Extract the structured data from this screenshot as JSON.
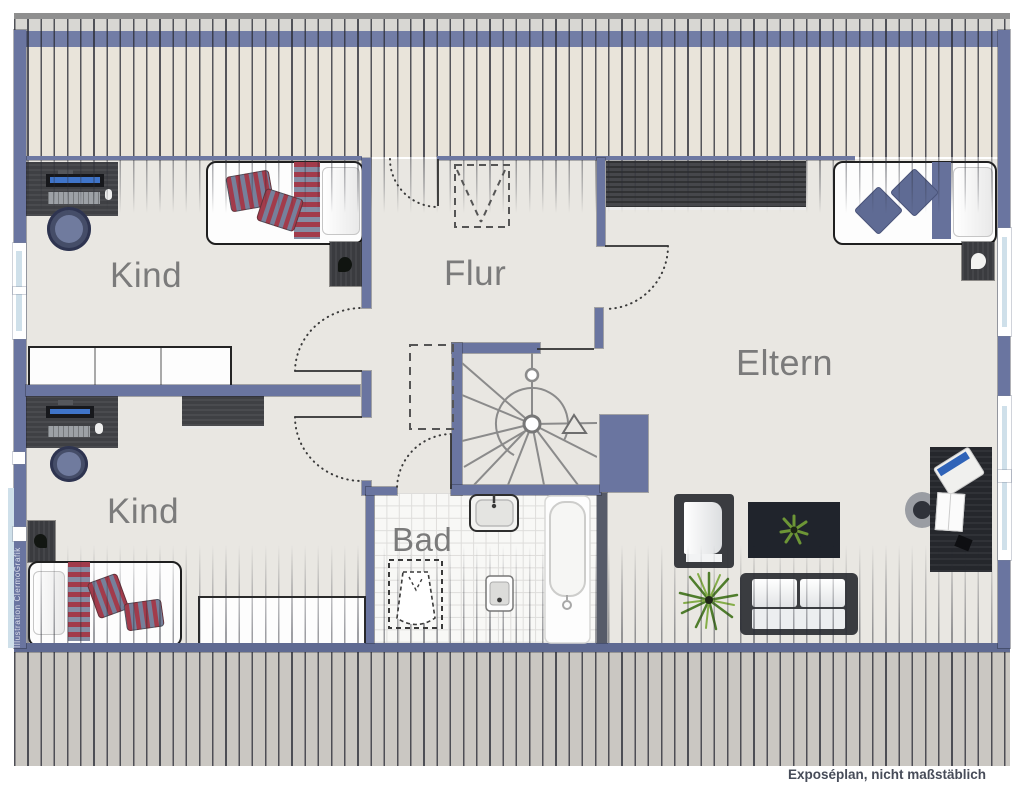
{
  "meta": {
    "caption": "Exposéplan, nicht maßstäblich",
    "watermark": "Illustration ClermoGrafik"
  },
  "rooms": [
    {
      "id": "kind-top",
      "label": "Kind",
      "furniture": [
        "desk-with-computer",
        "desk-chair",
        "single-bed",
        "nightstand",
        "wardrobe-white"
      ]
    },
    {
      "id": "kind-bottom",
      "label": "Kind",
      "furniture": [
        "desk-with-computer",
        "desk-chair",
        "dresser",
        "single-bed",
        "nightstand",
        "sideboard"
      ]
    },
    {
      "id": "flur",
      "label": "Flur",
      "features": [
        "dashed-cupboard",
        "eaves-access-door",
        "spiral-staircase"
      ]
    },
    {
      "id": "bad",
      "label": "Bad",
      "fixtures": [
        "washbasin",
        "toilet-dashed",
        "bidet",
        "bathtub"
      ]
    },
    {
      "id": "eltern",
      "label": "Eltern",
      "furniture": [
        "wardrobe",
        "double-bed",
        "nightstand",
        "armchair",
        "coffee-table-with-plant",
        "sofa",
        "floor-plant",
        "desk-with-laptop",
        "desk-chair"
      ]
    }
  ],
  "stairs": {
    "type": "spiral-staircase",
    "direction_arrow": "up"
  },
  "colors": {
    "wall_blue": "#6a75a0",
    "roof_hatch_bg": "#e9e4da",
    "outer_hatch_bg": "#cac7c2",
    "floor": "#e9e7e2",
    "bad_tile": "#f8f8f6",
    "accent_red": "#a23b4b",
    "accent_slate_blue": "#5f6b94",
    "label_gray": "#7b7b7b"
  }
}
